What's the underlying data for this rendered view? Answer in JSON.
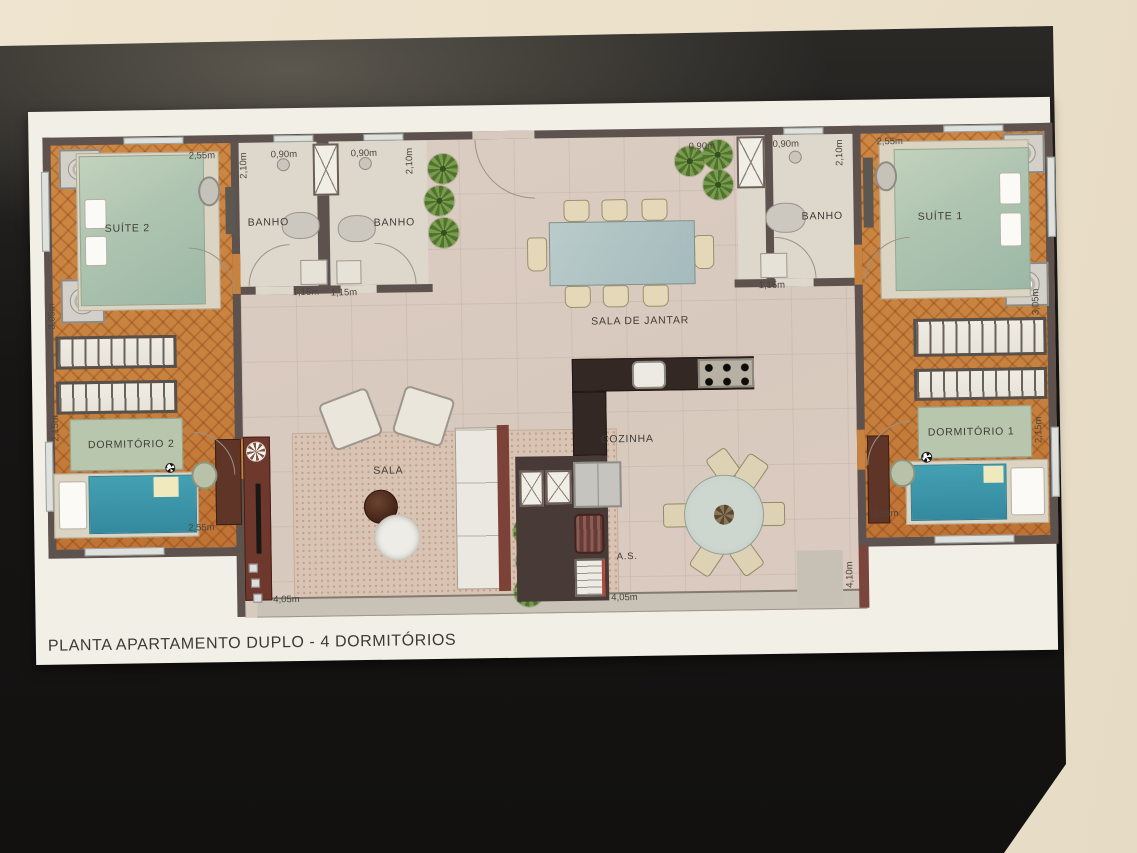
{
  "title": "PLANTA APARTAMENTO DUPLO - 4 DORMITÓRIOS",
  "rooms": {
    "suite2": "SUÍTE 2",
    "banho_left1": "BANHO",
    "banho_left2": "BANHO",
    "sala_de_jantar": "SALA DE JANTAR",
    "banho_right": "BANHO",
    "suite1": "SUÍTE 1",
    "dormitorio2": "DORMITÓRIO 2",
    "dormitorio1": "DORMITÓRIO 1",
    "sala": "SALA",
    "cozinha": "COZINHA",
    "area_servico": "A.S."
  },
  "dims": {
    "suite2_width": "2,55m",
    "suite2_depth": "3,05m",
    "banho_left1_width": "0,90m",
    "banho_left1_depth": "2,10m",
    "banho_left2_width": "0,90m",
    "banho_left2_depth": "2,10m",
    "banho_left1_shower": "1,15m",
    "banho_left2_shower": "1,15m",
    "center_top_width": "0,90m",
    "banho_right_width": "0,90m",
    "banho_right_depth": "2,10m",
    "banho_right_shower": "1,15m",
    "suite1_width": "2,55m",
    "suite1_depth": "3,05m",
    "dorm2_depth": "2,15m",
    "dorm2_width": "2,55m",
    "dorm1_depth": "2,15m",
    "dorm1_width": "2,55m",
    "sala_width": "4,05m",
    "service_width": "4,05m",
    "terrace_depth": "4,10m"
  },
  "colors": {
    "wall": "#ece1cb",
    "poster": "#1b1a18",
    "sheet": "#f2efe7",
    "planwall": "#5d524d",
    "wood": "#c8823f",
    "tile": "#d8c9be",
    "bath": "#ded8cc",
    "rug": "#d9c3b2",
    "bedgreen": "#aec4b0",
    "bedteal": "#43a0b2",
    "counter": "#332823",
    "sideboard": "#6e382c",
    "balcony": "#c9c2b6",
    "plant": "#5f7f37",
    "maroon": "#7a463c"
  }
}
